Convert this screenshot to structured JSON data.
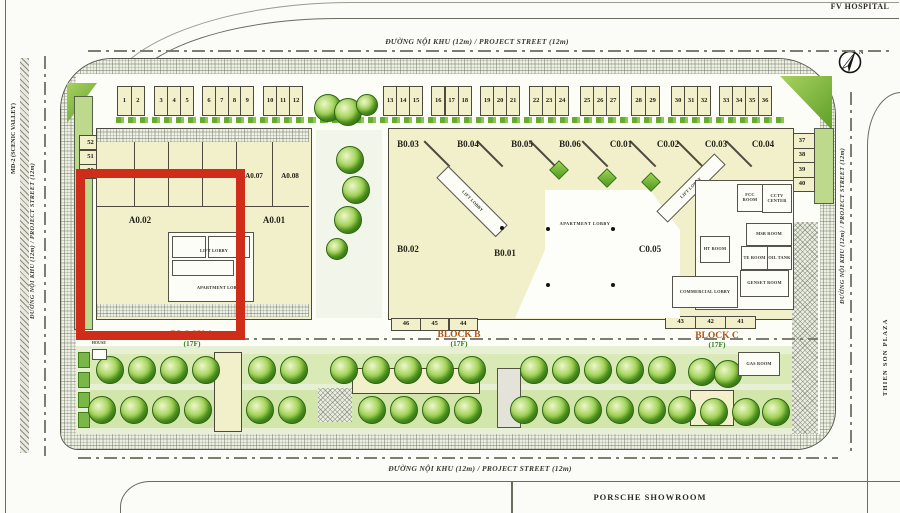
{
  "surroundings": {
    "fv_hospital": "FV HOSPITAL",
    "porsche_showroom": "PORSCHE SHOWROOM",
    "thien_son_plaza": "THIEN SON PLAZA",
    "md2_scenic_valley": "MD-2 (SCENIC VALLEY)"
  },
  "streets": {
    "label": "ĐƯỜNG NỘI KHU (12m) / PROJECT STREET (12m)"
  },
  "compass": {
    "n": "N"
  },
  "shops_top": [
    "1",
    "2",
    "3",
    "4",
    "5",
    "6",
    "7",
    "8",
    "9",
    "10",
    "11",
    "12",
    "13",
    "14",
    "15",
    "16",
    "17",
    "18",
    "19",
    "20",
    "21",
    "22",
    "23",
    "24",
    "25",
    "26",
    "27",
    "28",
    "29",
    "30",
    "31",
    "32",
    "33",
    "34",
    "35",
    "36"
  ],
  "shops_left": [
    "52",
    "51",
    "50"
  ],
  "shops_right": [
    "37",
    "38",
    "39",
    "40"
  ],
  "shops_bottom_b": [
    "46",
    "45",
    "44"
  ],
  "shops_bottom_c": [
    "43",
    "42",
    "41"
  ],
  "block_a": {
    "name": "BLOCK A",
    "floors": "(17F)",
    "units_top": [
      "A0.03",
      "A0.04",
      "A0.05",
      "A0.06",
      "A0.07",
      "A0.08"
    ],
    "unit_left": "A0.02",
    "unit_right": "A0.01",
    "lift_lobby": "LIFT LOBBY",
    "apartment_lobby": "APARTMENT LOBBY"
  },
  "block_b": {
    "name": "BLOCK B",
    "floors": "(17F)",
    "units_top": [
      "B0.03",
      "B0.04",
      "B0.05",
      "B0.06",
      "C0.01"
    ],
    "unit_bottom_left": "B0.02",
    "unit_bottom_center": "B0.01",
    "lift_lobby": "LIFT LOBBY",
    "apartment_lobby": "APARTMENT LOBBY"
  },
  "block_c": {
    "name": "BLOCK C",
    "floors": "(17F)",
    "units_top": [
      "C0.02",
      "C0.03",
      "C0.04"
    ],
    "unit_main": "C0.05",
    "lift_lobby": "LIFT LOBBY",
    "rooms": [
      "FCC ROOM",
      "CCTV CENTER",
      "MSB ROOM",
      "HT ROOM",
      "TE ROOM",
      "OIL TANK",
      "GENSET ROOM",
      "COMMERCIAL LOBBY"
    ]
  },
  "site_notes": {
    "guard_house": "GUARD HOUSE",
    "gas_room": "GAS ROOM"
  },
  "highlight": {
    "color": "#cf2c1a"
  }
}
